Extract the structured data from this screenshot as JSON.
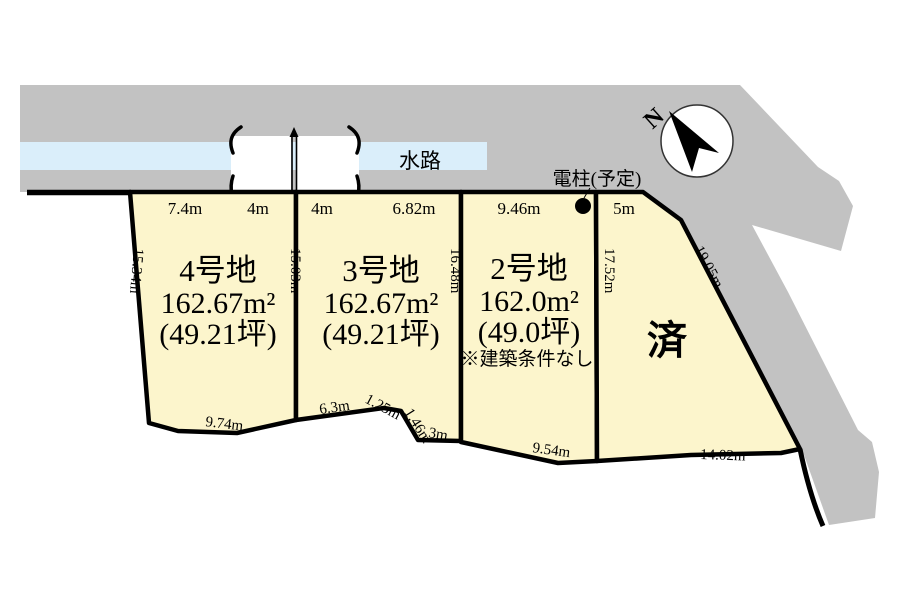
{
  "colors": {
    "background": "#ffffff",
    "road": "#c2c2c2",
    "water": "#daeefa",
    "plot_fill": "#fcf5cc",
    "outline": "#000000",
    "sold_red": "#d92a17"
  },
  "map": {
    "waterway_label": "水路",
    "pole_label": "電柱(予定)",
    "compass_label": "N"
  },
  "plots": [
    {
      "id": "lot4",
      "name": "4号地",
      "area_m2": "162.67m²",
      "area_tsubo": "(49.21坪)"
    },
    {
      "id": "lot3",
      "name": "3号地",
      "area_m2": "162.67m²",
      "area_tsubo": "(49.21坪)"
    },
    {
      "id": "lot2",
      "name": "2号地",
      "area_m2": "162.0m²",
      "area_tsubo": "(49.0坪)",
      "note": "※建築条件なし"
    },
    {
      "id": "lot1",
      "status": "済"
    }
  ],
  "dimensions": {
    "top": [
      "7.4m",
      "4m",
      "4m",
      "6.82m",
      "9.46m",
      "5m"
    ],
    "left_edge": "15.34m",
    "boundary_4_3": "15.03m",
    "boundary_3_2": "16.48m",
    "boundary_2_1": "17.52m",
    "diagonal_edge": "19.05m",
    "bottom_lot4": "9.74m",
    "bottom_lot3_a": "6.3m",
    "bottom_lot3_b": "1.25m",
    "bottom_lot3_c": "1.46m",
    "bottom_lot3_d": "3m",
    "bottom_lot2": "9.54m",
    "bottom_lot1": "14.02m"
  }
}
